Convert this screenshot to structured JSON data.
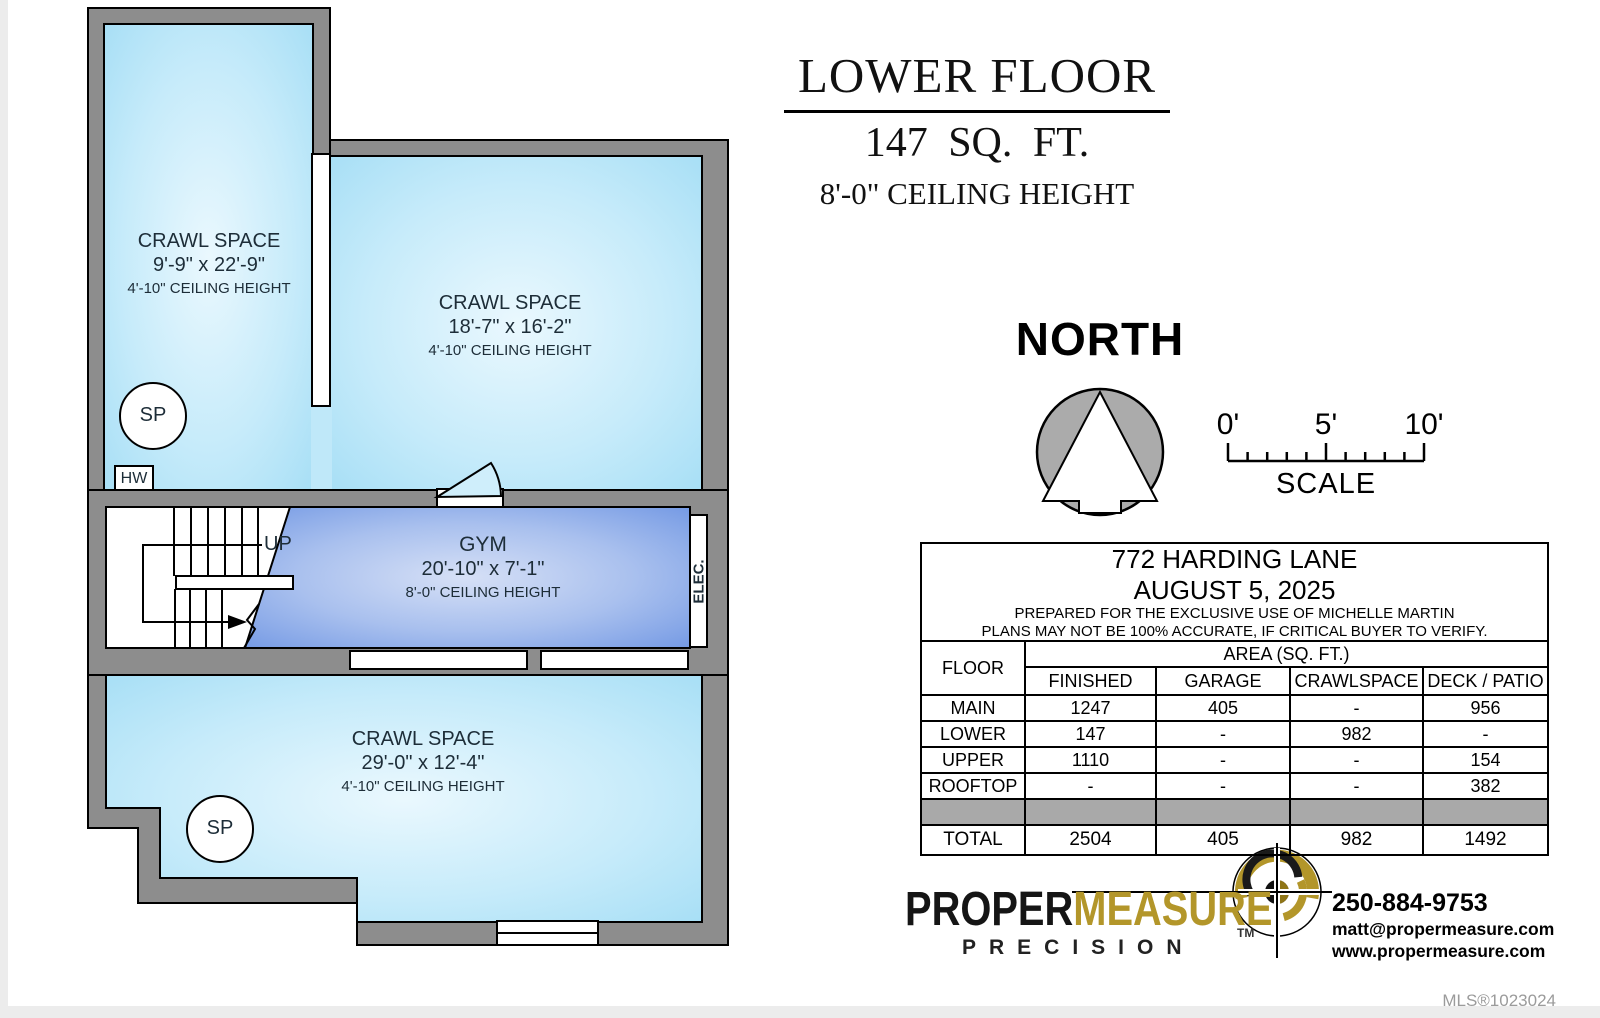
{
  "colors": {
    "wall_gray": "#8d8d8d",
    "room_blue": "#a3ddf5",
    "gym_blue": "#6e95e3",
    "brand_gold": "#b3962a",
    "table_spacer_gray": "#a9a9a9"
  },
  "title": {
    "heading": "LOWER FLOOR",
    "area": "147 SQ. FT.",
    "ceiling": "8'-0\" CEILING HEIGHT"
  },
  "compass": {
    "label": "NORTH"
  },
  "scale_bar": {
    "tick_0": "0'",
    "tick_5": "5'",
    "tick_10": "10'",
    "label": "SCALE"
  },
  "plan": {
    "rooms": {
      "crawl_upper_left": {
        "name": "CRAWL SPACE",
        "dims": "9'-9\" x 22'-9\"",
        "ceiling": "4'-10\" CEILING HEIGHT"
      },
      "crawl_upper_right": {
        "name": "CRAWL SPACE",
        "dims": "18'-7\" x 16'-2\"",
        "ceiling": "4'-10\" CEILING HEIGHT"
      },
      "gym": {
        "name": "GYM",
        "dims": "20'-10\" x 7'-1\"",
        "ceiling": "8'-0\" CEILING HEIGHT"
      },
      "crawl_lower": {
        "name": "CRAWL SPACE",
        "dims": "29'-0\" x 12'-4\"",
        "ceiling": "4'-10\" CEILING HEIGHT"
      }
    },
    "labels": {
      "sump_1": "SP",
      "sump_2": "SP",
      "hot_water": "HW",
      "stairs_up": "UP",
      "electrical": "ELEC."
    }
  },
  "info_table": {
    "address": "772 HARDING LANE",
    "date": "AUGUST 5, 2025",
    "prepared": "PREPARED FOR THE EXCLUSIVE USE OF MICHELLE MARTIN",
    "disclaimer": "PLANS MAY NOT BE 100% ACCURATE, IF CRITICAL BUYER TO VERIFY.",
    "floor_col": "FLOOR",
    "area_header": "AREA (SQ. FT.)",
    "columns": [
      "FINISHED",
      "GARAGE",
      "CRAWLSPACE",
      "DECK / PATIO"
    ],
    "rows": [
      {
        "floor": "MAIN",
        "finished": "1247",
        "garage": "405",
        "crawlspace": "-",
        "deck": "956"
      },
      {
        "floor": "LOWER",
        "finished": "147",
        "garage": "-",
        "crawlspace": "982",
        "deck": "-"
      },
      {
        "floor": "UPPER",
        "finished": "1110",
        "garage": "-",
        "crawlspace": "-",
        "deck": "154"
      },
      {
        "floor": "ROOFTOP",
        "finished": "-",
        "garage": "-",
        "crawlspace": "-",
        "deck": "382"
      }
    ],
    "total": {
      "floor": "TOTAL",
      "finished": "2504",
      "garage": "405",
      "crawlspace": "982",
      "deck": "1492"
    }
  },
  "branding": {
    "brand_part1": "PROPER",
    "brand_part2": "MEASURE",
    "trademark": "TM",
    "tagline": "PRECISION",
    "phone": "250-884-9753",
    "email": "matt@propermeasure.com",
    "website": "www.propermeasure.com"
  },
  "footer": {
    "mls": "MLS®1023024"
  }
}
